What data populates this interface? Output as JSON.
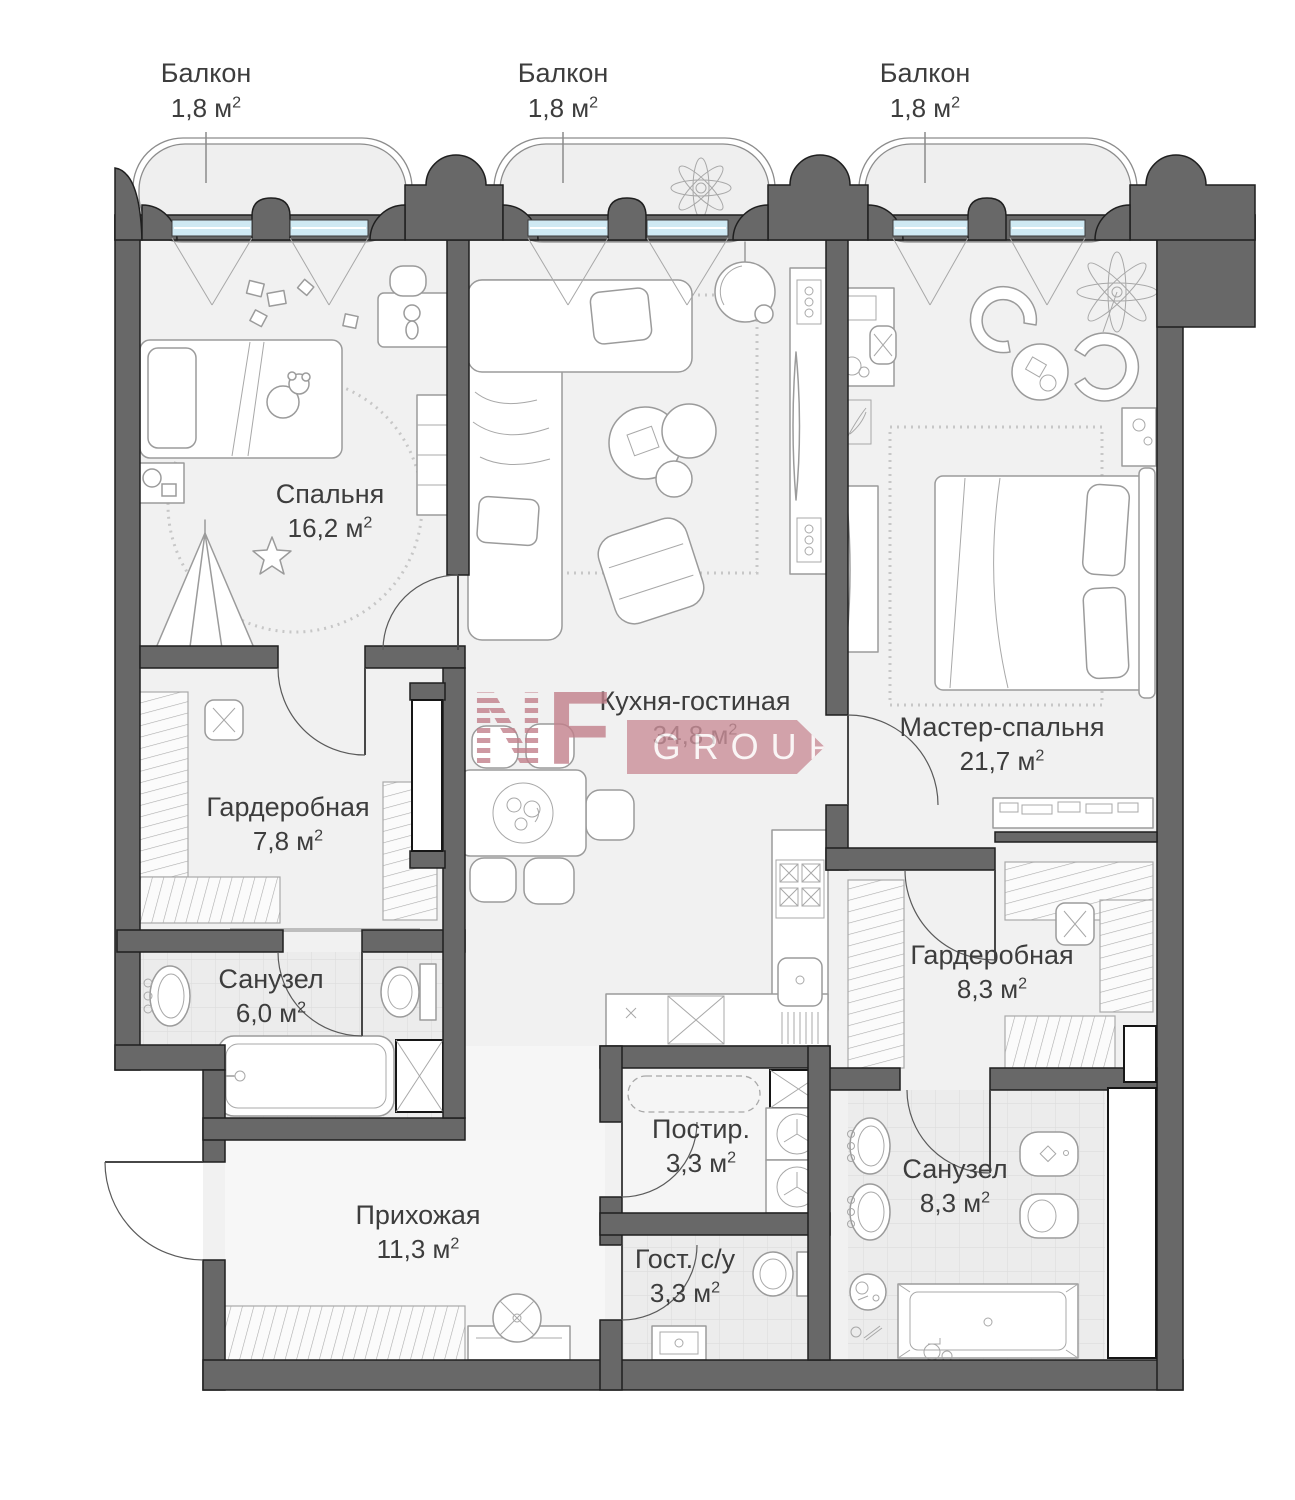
{
  "meta": {
    "sup2": "2"
  },
  "balconies": [
    {
      "label": "Балкон",
      "area": "1,8 м"
    },
    {
      "label": "Балкон",
      "area": "1,8 м"
    },
    {
      "label": "Балкон",
      "area": "1,8 м"
    }
  ],
  "rooms": [
    {
      "id": "bedroom",
      "label": "Спальня",
      "area": "16,2 м"
    },
    {
      "id": "kitchen-living",
      "label": "Кухня-гостиная",
      "area": "34,8 м"
    },
    {
      "id": "master-bedroom",
      "label": "Мастер-спальня",
      "area": "21,7 м"
    },
    {
      "id": "wardrobe-1",
      "label": "Гардеробная",
      "area": "7,8 м"
    },
    {
      "id": "bathroom-1",
      "label": "Санузел",
      "area": "6,0 м"
    },
    {
      "id": "wardrobe-2",
      "label": "Гардеробная",
      "area": "8,3 м"
    },
    {
      "id": "laundry",
      "label": "Постир.",
      "area": "3,3 м"
    },
    {
      "id": "guest-wc",
      "label": "Гост. с/у",
      "area": "3,3 м"
    },
    {
      "id": "bathroom-2",
      "label": "Санузел",
      "area": "8,3 м"
    },
    {
      "id": "hallway",
      "label": "Прихожая",
      "area": "11,3 м"
    }
  ],
  "watermark": {
    "letter_n": "N",
    "letter_f": "F",
    "group": "GROUP"
  },
  "colors": {
    "wall": "#686868",
    "window": "#cfe9f3",
    "accent": "#c2808b",
    "floor": "#f1f1f1"
  }
}
